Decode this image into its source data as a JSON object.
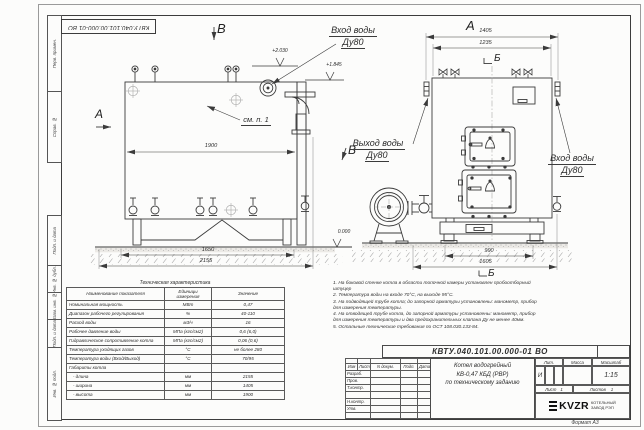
{
  "top_stamp": {
    "doc_number": "КВТУ.040.101.00.000-01 ВО"
  },
  "margin_column": {
    "items": [
      "Перв. примен.",
      "Справ. №",
      "Подп. и дата",
      "Инв. № дубл.",
      "Взам. инв. №",
      "Подп. и дата",
      "Инв. № подл."
    ]
  },
  "markers": {
    "a_left": "А",
    "v_top": "В",
    "v_mid": "В",
    "a_right": "А",
    "b_top": "Б",
    "b_bottom": "Б"
  },
  "labels": {
    "inlet_top_1": "Вход воды",
    "inlet_top_2": "Ду80",
    "outlet_1": "Выход воды",
    "outlet_2": "Ду80",
    "inlet_right_1": "Вход воды",
    "inlet_right_2": "Ду80",
    "see_note": "см. п. 1"
  },
  "elevations": {
    "top": "+2.030",
    "pipe": "+1.845",
    "ground": "0.000"
  },
  "dimensions": {
    "left_view": {
      "width": "1900",
      "base": "1650",
      "total": "2155"
    },
    "right_view": {
      "outer": "1405",
      "inner": "1235",
      "base_inner": "990",
      "base_outer": "1605"
    }
  },
  "spec_table": {
    "title": "Техническая характеристика",
    "headers": [
      "Наименование показателя",
      "Единицы измерения",
      "Значение"
    ],
    "rows": [
      [
        "Номинальная мощность",
        "МВт",
        "0,47"
      ],
      [
        "Диапазон рабочего регулирования",
        "%",
        "40-110"
      ],
      [
        "Расход воды",
        "м3/ч",
        "16"
      ],
      [
        "Рабочее давление воды",
        "МПа (кгс/см2)",
        "0,6 (6,0)"
      ],
      [
        "Гидравлическое сопротивление котла",
        "МПа (кгс/см2)",
        "0,06 (0,6)"
      ],
      [
        "Температура уходящих газов",
        "°С",
        "не более 280"
      ],
      [
        "Температура воды (Вход/Выход)",
        "°С",
        "70/95"
      ],
      [
        "Габариты котла",
        "",
        ""
      ],
      [
        "   - длина",
        "мм",
        "2155"
      ],
      [
        "   - ширина",
        "мм",
        "1405"
      ],
      [
        "   - высота",
        "мм",
        "1900"
      ]
    ]
  },
  "notes": {
    "lines": [
      "1. На боковой стенке котла в области топочной камеры установлен пробоотборный штуцер",
      "2. Температура воды на входе 70°С, на выходе 95°С.",
      "3. На подводящей трубе котла; до запорной арматуры установлены: манометр, прибор для измерения температуры.",
      "4. На отводящей трубе котла, до запорной арматуры установлены: манометр, прибор для измерения температуры и два предохранительных клапана Ду не менее 40мм.",
      "5. Остальные технические требования по ОСТ 108.030.133-84."
    ]
  },
  "title_block": {
    "doc_number": "КВТУ.040.101.00.000-01 ВО",
    "col_headers": [
      "Изм",
      "Лист",
      "N докум.",
      "Подп.",
      "Дата"
    ],
    "rows": [
      "Разраб.",
      "Пров.",
      "Т.контр.",
      "",
      "Н.контр.",
      "Утв."
    ],
    "product_title_1": "Котел водогрейный",
    "product_title_2": "КВ-0,47 КБД (РВР)",
    "product_title_3": "по техническому заданию",
    "lit_label": "Лит.",
    "lit_value": "И",
    "mass_label": "Масса",
    "scale_label": "Масштаб",
    "scale_value": "1:15",
    "sheet_label": "Лист",
    "sheet_value": "1",
    "sheets_label": "Листов",
    "sheets_value": "1",
    "logo_text": "KVZR",
    "logo_caption_1": "КОТЕЛЬНЫЙ",
    "logo_caption_2": "ЗАВОД РЭП",
    "format_label": "Формат А3"
  },
  "colors": {
    "line": "#3b3b3b",
    "paper": "#fcfcfb",
    "logo": "#111111"
  }
}
